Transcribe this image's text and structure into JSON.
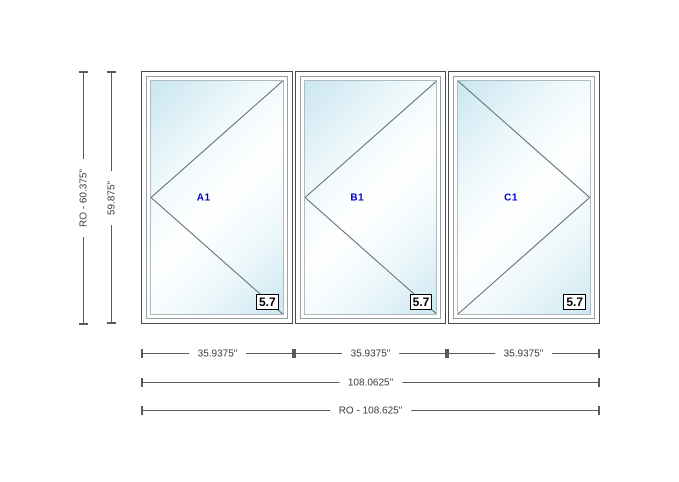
{
  "drawing": {
    "panels": [
      {
        "label": "A1",
        "badge": "5.7",
        "hinge": "left"
      },
      {
        "label": "B1",
        "badge": "5.7",
        "hinge": "left"
      },
      {
        "label": "C1",
        "badge": "5.7",
        "hinge": "right"
      }
    ]
  },
  "dimensions": {
    "vertical_ro": "RO - 60.375\"",
    "vertical_frame": "59.875\"",
    "panel_widths": [
      "35.9375\"",
      "35.9375\"",
      "35.9375\""
    ],
    "total_width": "108.0625\"",
    "total_ro_width": "RO - 108.625\""
  },
  "colors": {
    "glass_tint": "#cbe7f2",
    "panel_label_blue": "#0000cc",
    "dimension_line": "#5a5a5a",
    "frame_border": "#4a4a4a"
  }
}
